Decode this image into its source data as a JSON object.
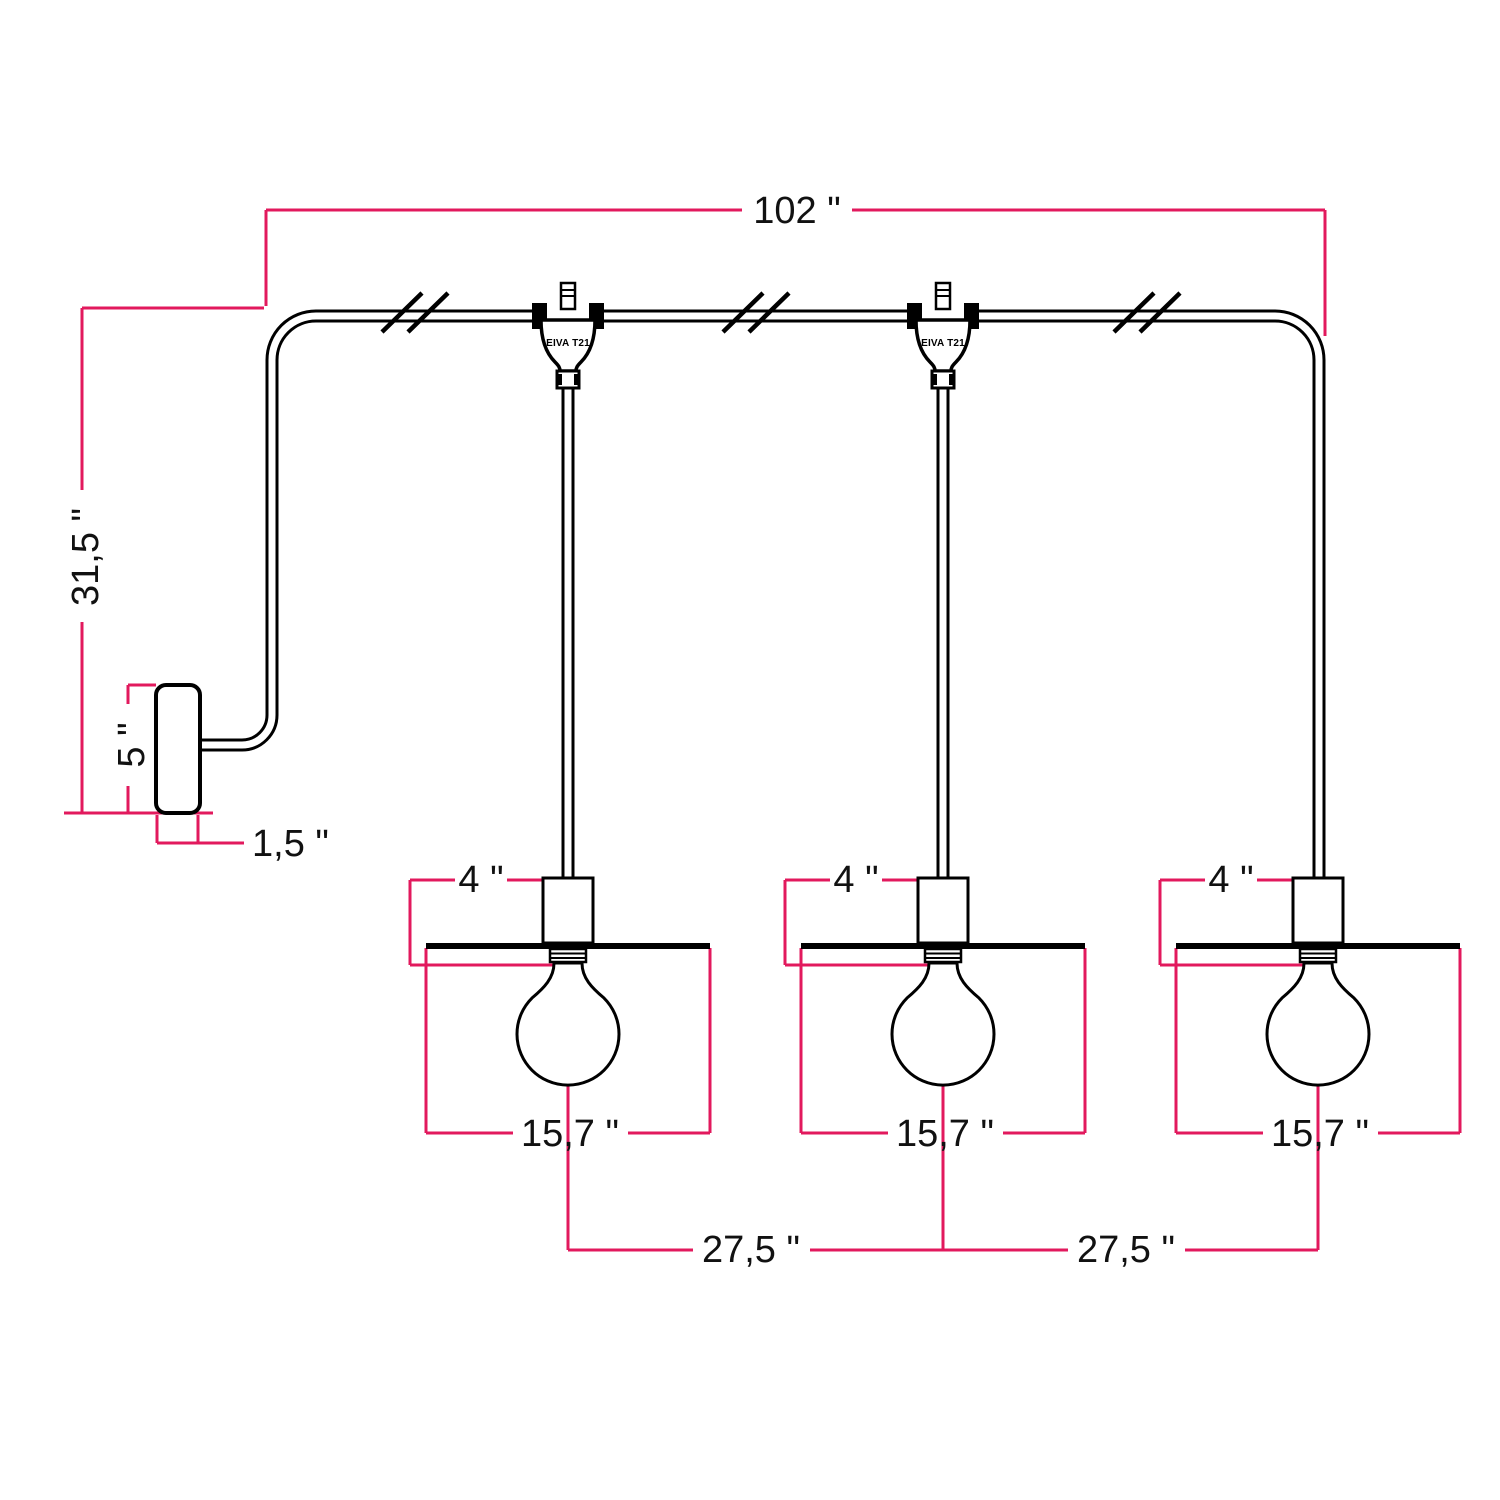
{
  "diagram": {
    "dimensions": {
      "cable_run": "102 \"",
      "wall_drop": "31,5 \"",
      "wall_plate_height": "5 \"",
      "wall_plate_depth": "1,5 \"",
      "socket_height": "4 \"",
      "shade_diameter": "15,7 \"",
      "lamp_spacing": "27,5 \""
    },
    "labels": {
      "t_connector": "EIVA T21"
    },
    "colors": {
      "dimension_line": "#E2195D",
      "drawing_line": "#000000",
      "background": "#FFFFFF"
    }
  }
}
